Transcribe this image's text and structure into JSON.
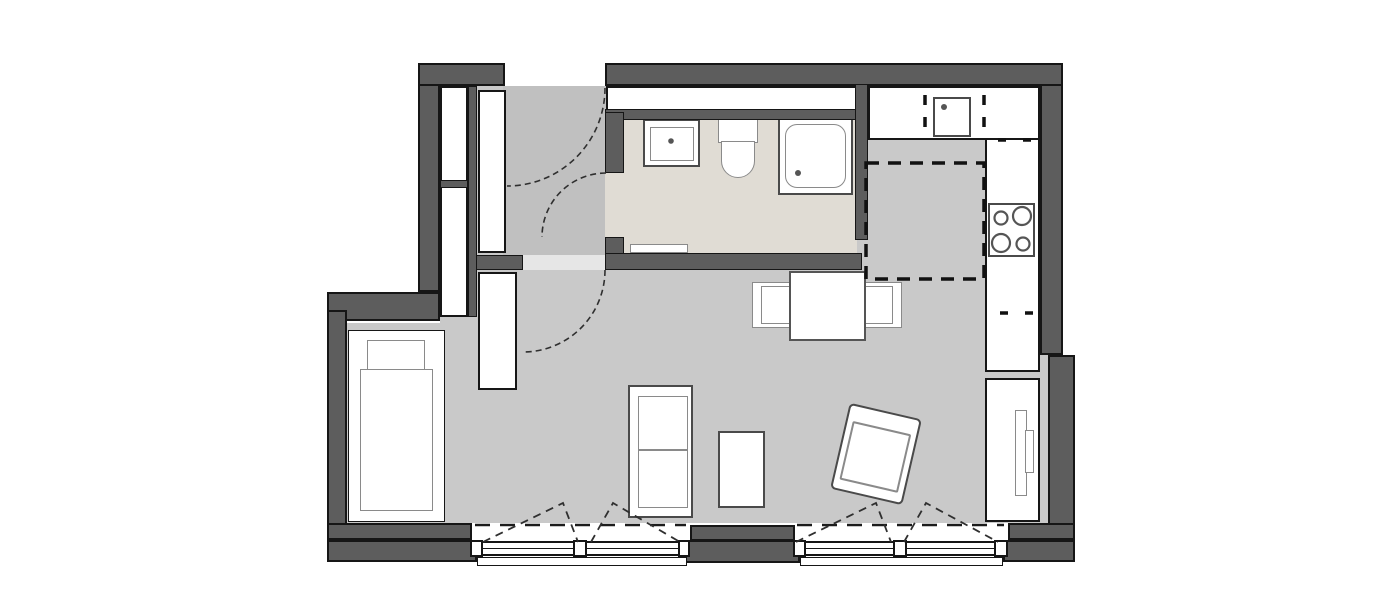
{
  "document": {
    "type": "architectural-floor-plan",
    "title": "Studio apartment floor plan",
    "visible_text": []
  },
  "colors": {
    "bg": "#ffffff",
    "wall": "#5d5d5d",
    "line": "#161616",
    "floor": "#c9c9c9",
    "floor-hall": "#c0c0c0",
    "floor-bath": "#e0dcd4",
    "fixture": "#ffffff",
    "outline-soft": "#8a8a8a",
    "outline-mid": "#4a4a4a",
    "threshold": "#e6e6e6"
  },
  "rooms": [
    {
      "id": "entry-hall",
      "floor": "light-gray"
    },
    {
      "id": "bathroom",
      "floor": "beige"
    },
    {
      "id": "kitchen",
      "floor": "light-gray"
    },
    {
      "id": "living-sleeping-area",
      "floor": "light-gray"
    }
  ],
  "openings": [
    {
      "id": "entry-door",
      "type": "swing-door",
      "wall": "north"
    },
    {
      "id": "bathroom-door",
      "type": "swing-door",
      "wall": "hall-bathroom"
    },
    {
      "id": "room-door",
      "type": "swing-door",
      "wall": "hall-living"
    },
    {
      "id": "window-1",
      "type": "double-sash-window",
      "wall": "south",
      "tilt_marks": true
    },
    {
      "id": "window-2",
      "type": "double-sash-window",
      "wall": "south",
      "tilt_marks": true
    }
  ],
  "fixtures": [
    {
      "id": "bathroom-sink"
    },
    {
      "id": "toilet"
    },
    {
      "id": "shower"
    },
    {
      "id": "bathroom-radiator"
    },
    {
      "id": "kitchen-counter-top"
    },
    {
      "id": "kitchen-counter-right"
    },
    {
      "id": "kitchen-sink"
    },
    {
      "id": "cooktop",
      "burners": 4
    },
    {
      "id": "kitchen-dashed-tall-unit"
    },
    {
      "id": "tall-cabinet-right"
    },
    {
      "id": "duct-shaft-above-bathroom"
    }
  ],
  "furniture": [
    {
      "id": "bed",
      "parts": [
        "pillow",
        "mattress"
      ]
    },
    {
      "id": "hall-closet-upper"
    },
    {
      "id": "hall-closet-lower"
    },
    {
      "id": "hall-cabinet"
    },
    {
      "id": "wardrobe"
    },
    {
      "id": "shelf-unit"
    },
    {
      "id": "stool"
    },
    {
      "id": "dining-table"
    },
    {
      "id": "dining-chair-left"
    },
    {
      "id": "dining-chair-right"
    },
    {
      "id": "armchair",
      "rotation_deg": 13
    }
  ]
}
